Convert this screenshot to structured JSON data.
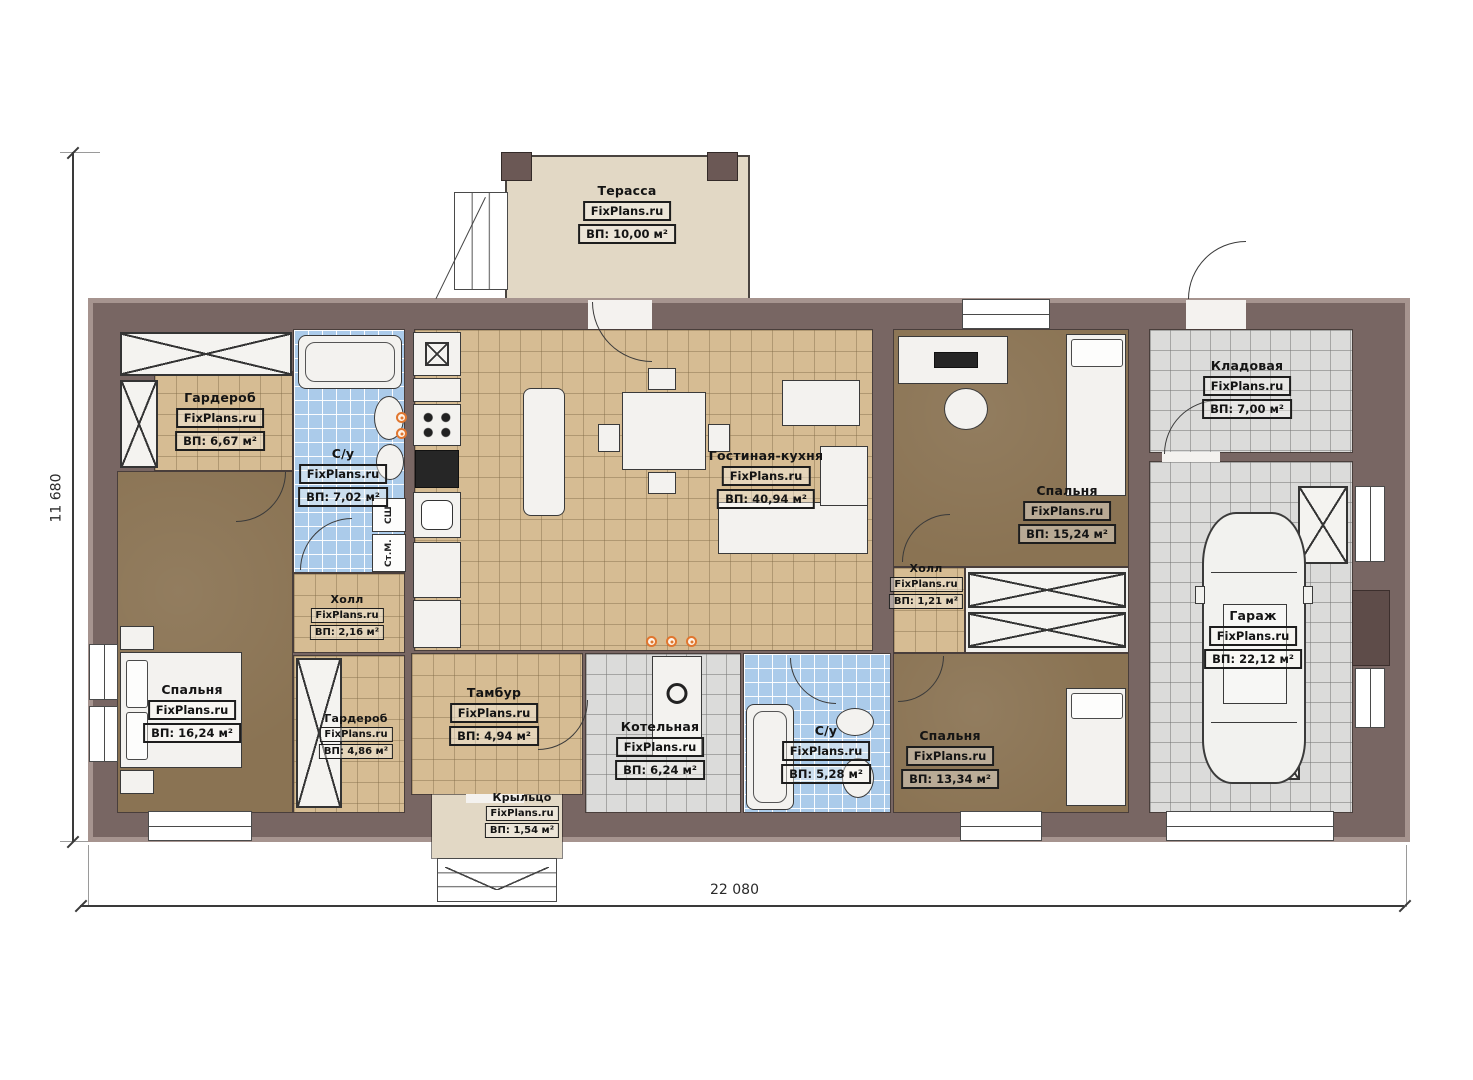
{
  "meta": {
    "brand": "FixPlans.ru"
  },
  "dimensions": {
    "height_label": "11 680",
    "width_label": "22 080"
  },
  "rooms": [
    {
      "name": "Терасса",
      "area": "ВП: 10,00 м²"
    },
    {
      "name": "Гардероб",
      "area": "ВП: 6,67 м²"
    },
    {
      "name": "С/у",
      "area": "ВП: 7,02 м²"
    },
    {
      "name": "Гостиная-кухня",
      "area": "ВП: 40,94 м²"
    },
    {
      "name": "Спальня",
      "area": "ВП: 15,24 м²"
    },
    {
      "name": "Кладовая",
      "area": "ВП: 7,00 м²"
    },
    {
      "name": "Холл",
      "area": "ВП: 1,21 м²"
    },
    {
      "name": "Гараж",
      "area": "ВП: 22,12 м²"
    },
    {
      "name": "Спальня",
      "area": "ВП: 16,24 м²"
    },
    {
      "name": "Холл",
      "area": "ВП: 2,16 м²"
    },
    {
      "name": "Гардероб",
      "area": "ВП: 4,86 м²"
    },
    {
      "name": "Тамбур",
      "area": "ВП: 4,94 м²"
    },
    {
      "name": "Котельная",
      "area": "ВП: 6,24 м²"
    },
    {
      "name": "С/у",
      "area": "ВП: 5,28 м²"
    },
    {
      "name": "Спальня",
      "area": "ВП: 13,34 м²"
    },
    {
      "name": "Крыльцо",
      "area": "ВП: 1,54 м²"
    }
  ],
  "appliances": {
    "dryer": "СШ",
    "washer": "Ст.М."
  },
  "colors": {
    "wall": "#786663",
    "wall_edge": "#a6948f",
    "tile_tan": "#d6bc93",
    "tile_blue": "#abcbea",
    "tile_gray": "#dbdbda",
    "floor_brown": "#8a7353",
    "terrace": "#e2d8c5",
    "accent_orange": "#e0762f"
  }
}
